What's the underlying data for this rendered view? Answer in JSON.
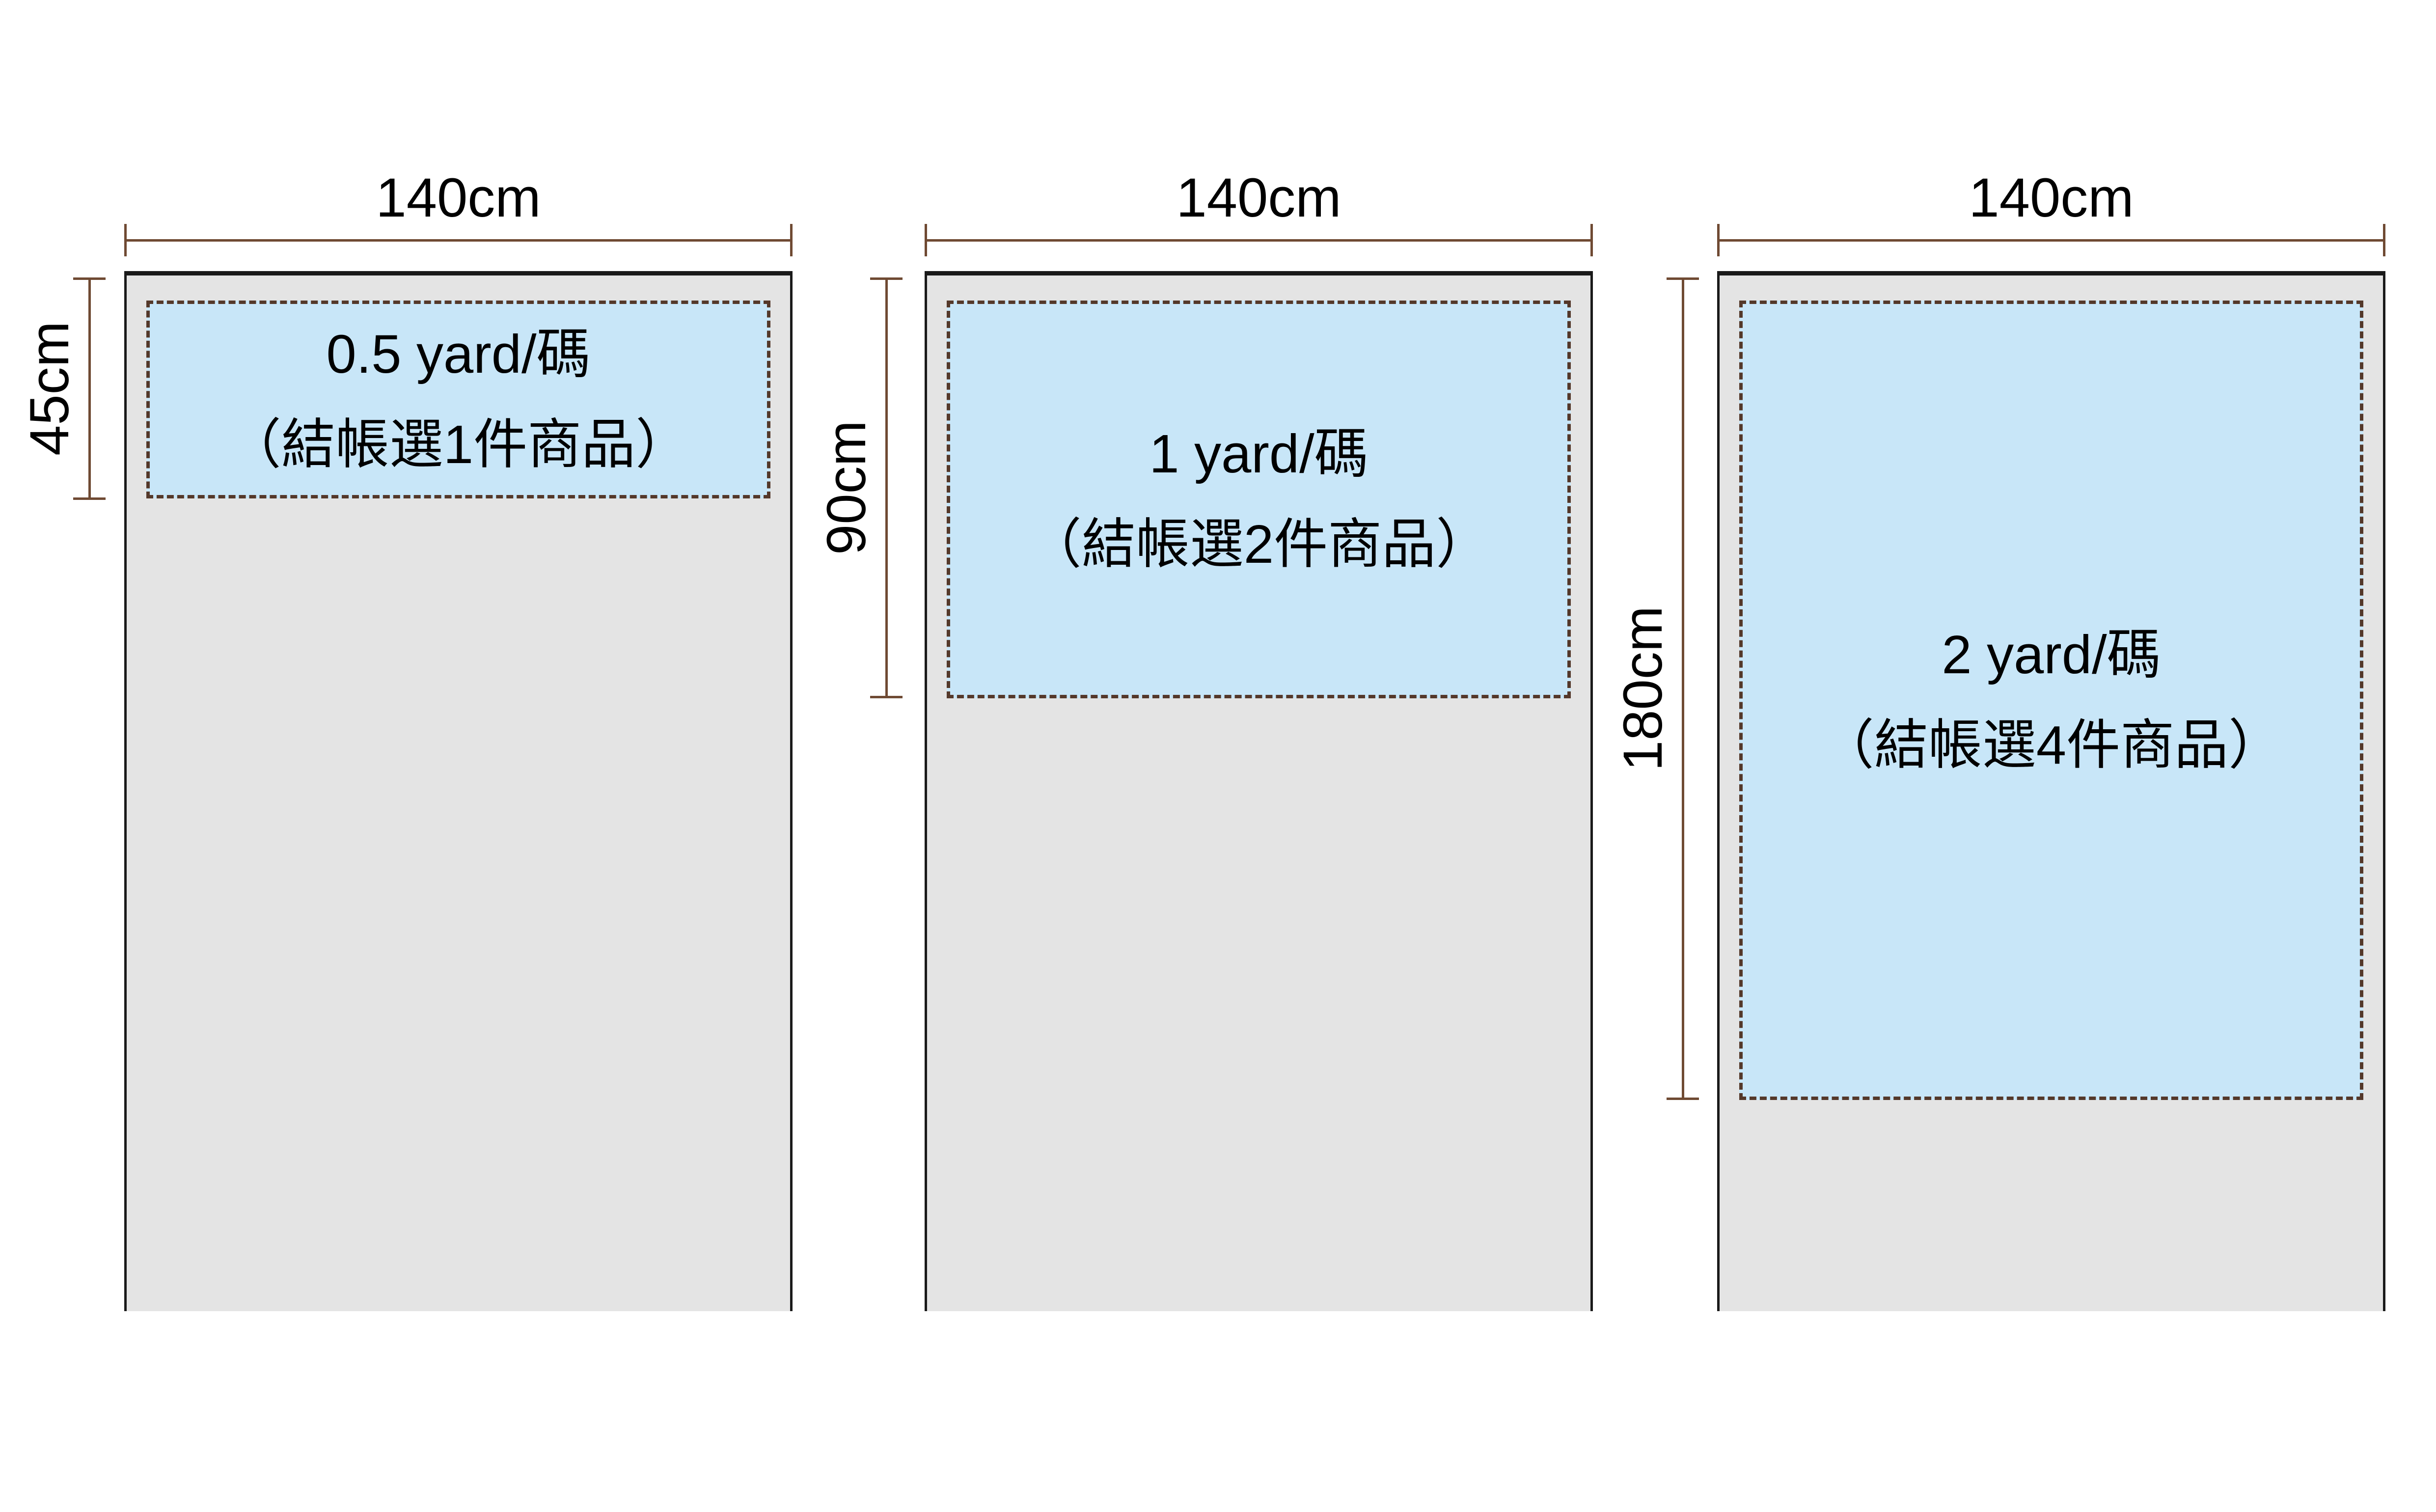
{
  "colors": {
    "background": "#ffffff",
    "fabric_fill": "#e4e4e4",
    "fabric_border": "#1a1a1a",
    "cut_fill": "#c8e6f8",
    "cut_border": "#54382a",
    "dimension_line": "#6f4a33",
    "text": "#000000"
  },
  "panels": [
    {
      "width_label": "140cm",
      "height_label": "45cm",
      "yardage_line": "0.5 yard/碼",
      "note_line": "（結帳選1件商品）"
    },
    {
      "width_label": "140cm",
      "height_label": "90cm",
      "yardage_line": "1 yard/碼",
      "note_line": "（結帳選2件商品）"
    },
    {
      "width_label": "140cm",
      "height_label": "180cm",
      "yardage_line": "2 yard/碼",
      "note_line": "（結帳選4件商品）"
    }
  ]
}
